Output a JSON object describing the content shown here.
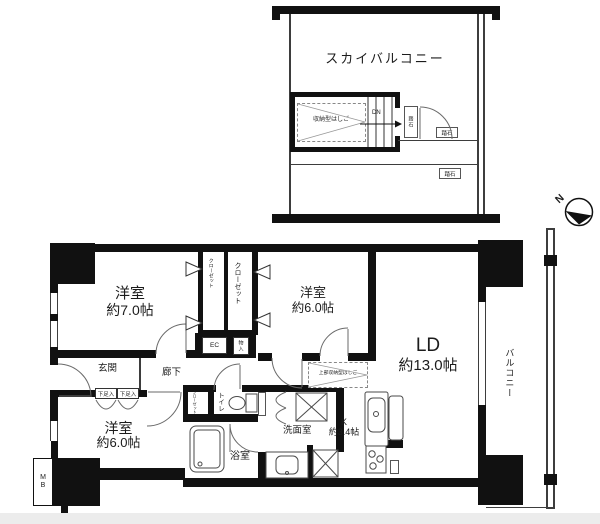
{
  "sky": {
    "title": "スカイバルコニー",
    "ladder": "収納型はしご",
    "dn": "DN",
    "stone": "踏石"
  },
  "compass": {
    "north": "N"
  },
  "rooms": {
    "bedroom7": {
      "name": "洋室",
      "size": "約7.0帖"
    },
    "bedroom6": {
      "name": "洋室",
      "size": "約6.0帖"
    },
    "bedroom6b": {
      "name": "洋室",
      "size": "約6.0帖"
    },
    "ld": {
      "name": "LD",
      "size": "約13.0帖"
    },
    "kitchen": {
      "name": "K",
      "size": "約3.4帖"
    }
  },
  "labels": {
    "entrance": "玄関",
    "hallway": "廊下",
    "toilet": "トイレ",
    "washroom": "洗面室",
    "bathroom": "浴室",
    "balcony": "バルコニー",
    "counter": "カウンター",
    "closet": "クローゼット",
    "storage": "物入",
    "shoe_cabinet": "下足入",
    "ec": "EC",
    "meter_box": "MB",
    "ladder_above": "上部収納型はしご"
  },
  "colors": {
    "wall": "#111111",
    "line": "#3d3d3d",
    "bg": "#ffffff"
  }
}
